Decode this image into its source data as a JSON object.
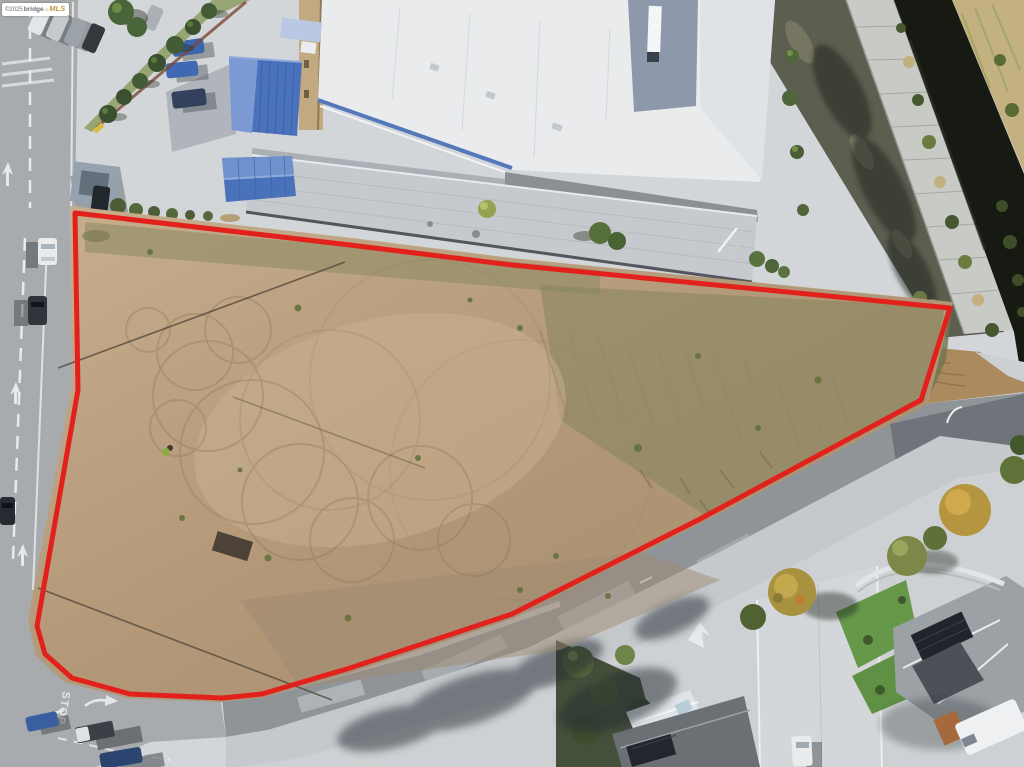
{
  "watermark": {
    "copyright": "©2025",
    "brand": "bridge",
    "brand_suffix": "MLS",
    "logo_glyph": "⌂",
    "bg_color": "#ffffff",
    "text_color": "#6e6e6e",
    "gold_color": "#bf9a3e"
  },
  "parcel": {
    "outline_color": "#e3211c",
    "outline_width": "5",
    "points": "75,213 350,245 512,265 950,308 921,400 700,519 512,614 350,668 262,694 222,698 130,694 72,678 45,654 37,626 78,390"
  },
  "markings": {
    "stop": "STOP",
    "marking_color": "#ffffff"
  },
  "palette": {
    "dirt": "#b39878",
    "dirt_light": "#c9b28f",
    "dirt_olive": "#85855c",
    "road_gray": "#a8abae",
    "asphalt": "#8f9499",
    "concrete": "#d3d6d8",
    "roof_white": "#e9ebed",
    "roof_blue": "#4a72ba",
    "warehouse_gray": "#c6c9cd",
    "canal_water": "#171a12",
    "canal_concrete": "#c8cac6",
    "gravel": "#5c5e4f",
    "lawn_green": "#66984a",
    "solar_panel": "#23272d",
    "shadow": "#3c4248"
  }
}
